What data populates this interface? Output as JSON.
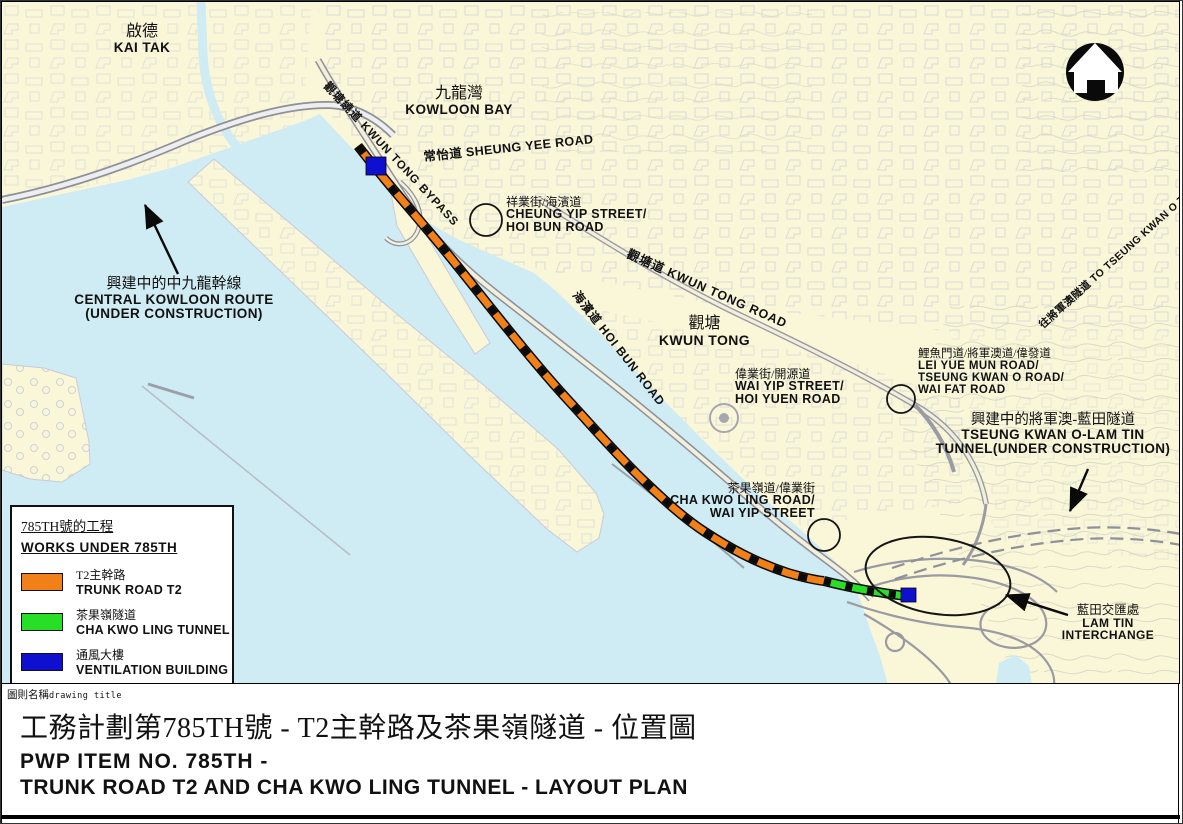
{
  "colors": {
    "land": "#FAF7D8",
    "water": "#CFEBF4",
    "trunk_road_orange": "#F28018",
    "tunnel_green": "#28DF28",
    "ventilation_blue": "#0F0FD0",
    "road_casing": "#8f9098"
  },
  "icons": {
    "north_arrow": "north-arrow"
  },
  "map": {
    "labels": {
      "kai_tak": {
        "cn": "啟德",
        "en": "KAI TAK"
      },
      "kowloon_bay": {
        "cn": "九龍灣",
        "en": "KOWLOON BAY"
      },
      "sheung_yee_road": {
        "text": "常怡道 SHEUNG YEE ROAD"
      },
      "cheung_yip": {
        "cn": "祥業街/海濱道",
        "en1": "CHEUNG YIP STREET/",
        "en2": "HOI BUN ROAD"
      },
      "kwun_tong_road": {
        "text": "觀塘道 KWUN TONG ROAD"
      },
      "kwun_tong": {
        "cn": "觀塘",
        "en": "KWUN TONG"
      },
      "hoi_bun_road": {
        "text": "海濱道 HOI BUN ROAD"
      },
      "wai_yip": {
        "cn": "偉業街/開源道",
        "en1": "WAI YIP STREET/",
        "en2": "HOI YUEN ROAD"
      },
      "lei_yue_mun": {
        "cn": "鯉魚門道/將軍澳道/偉發道",
        "en1": "LEI YUE MUN ROAD/",
        "en2": "TSEUNG KWAN O ROAD/",
        "en3": "WAI FAT ROAD"
      },
      "tko_lt_tunnel": {
        "cn": "興建中的將軍澳-藍田隧道",
        "en1": "TSEUNG KWAN O-LAM TIN",
        "en2": "TUNNEL(UNDER CONSTRUCTION)"
      },
      "central_kowloon_route": {
        "cn": "興建中的中九龍幹線",
        "en1": "CENTRAL KOWLOON ROUTE",
        "en2": "(UNDER CONSTRUCTION)"
      },
      "cha_kwo_ling_road": {
        "cn": "茶果嶺道/偉業街",
        "en1": "CHA KWO LING ROAD/",
        "en2": "WAI YIP STREET"
      },
      "lam_tin_interchange": {
        "cn": "藍田交匯處",
        "en1": "LAM TIN",
        "en2": "INTERCHANGE"
      },
      "to_tko_tunnel": {
        "text": "往將軍澳隧道 TO TSEUNG KWAN O TUNNEL"
      },
      "kwun_tong_bypass": {
        "text": "觀塘繞道 KWUN TONG BYPASS"
      }
    }
  },
  "legend": {
    "title_cn": "785TH號的工程",
    "title_en": "WORKS UNDER 785TH",
    "items": [
      {
        "cn": "T2主幹路",
        "en": "TRUNK ROAD T2",
        "color": "#F28018"
      },
      {
        "cn": "茶果嶺隧道",
        "en": "CHA KWO LING TUNNEL",
        "color": "#28DF28"
      },
      {
        "cn": "通風大樓",
        "en": "VENTILATION BUILDING",
        "color": "#0F0FD0"
      }
    ]
  },
  "title_block": {
    "label_cn": "圖則名稱",
    "label_en": "drawing title",
    "title_cn": "工務計劃第785TH號 - T2主幹路及茶果嶺隧道 - 位置圖",
    "title_en_line1": "PWP ITEM NO. 785TH -",
    "title_en_line2": "TRUNK ROAD T2 AND CHA KWO LING TUNNEL - LAYOUT PLAN"
  }
}
